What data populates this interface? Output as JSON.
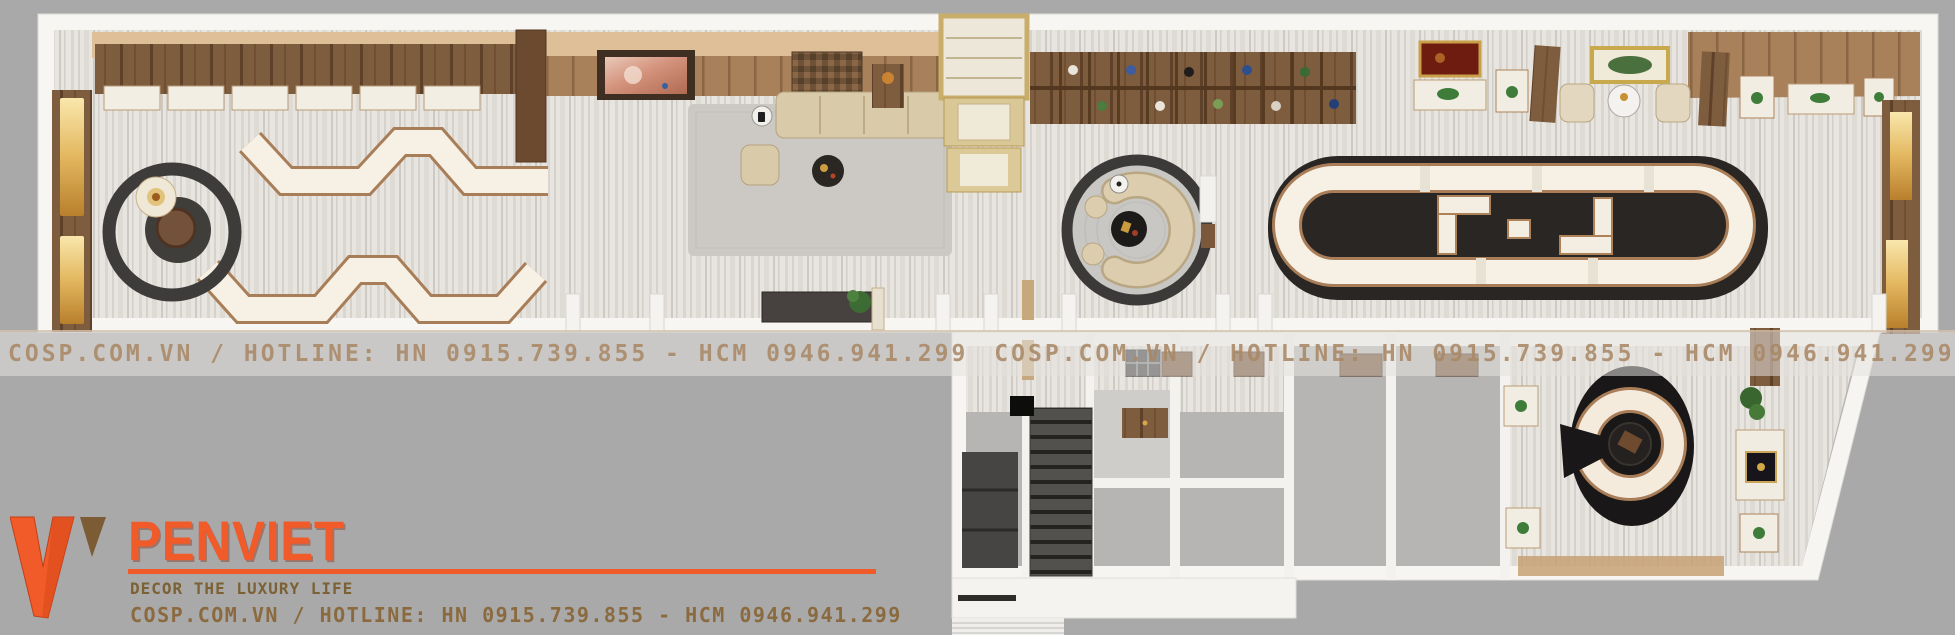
{
  "watermark": {
    "text": "COSP.COM.VN / HOTLINE: HN 0915.739.855 - HCM 0946.941.299"
  },
  "logo": {
    "brand": "PENVIET",
    "tagline": "DECOR THE LUXURY LIFE",
    "contact": "COSP.COM.VN / HOTLINE: HN 0915.739.855 - HCM 0946.941.299"
  },
  "colors": {
    "background": "#a9a9a9",
    "brand-orange": "#f15a29",
    "brand-brown": "#8a6a3e",
    "watermark-tan": "#a98865",
    "wall-white": "#f7f6f3",
    "floor-marble": "#e8e5e0",
    "wood": "#7e5c3e",
    "counter-cream": "#f6f0e5",
    "counter-copper": "#a87d57",
    "gold": "#e3b75f",
    "dark-accent": "#3b3a38"
  }
}
